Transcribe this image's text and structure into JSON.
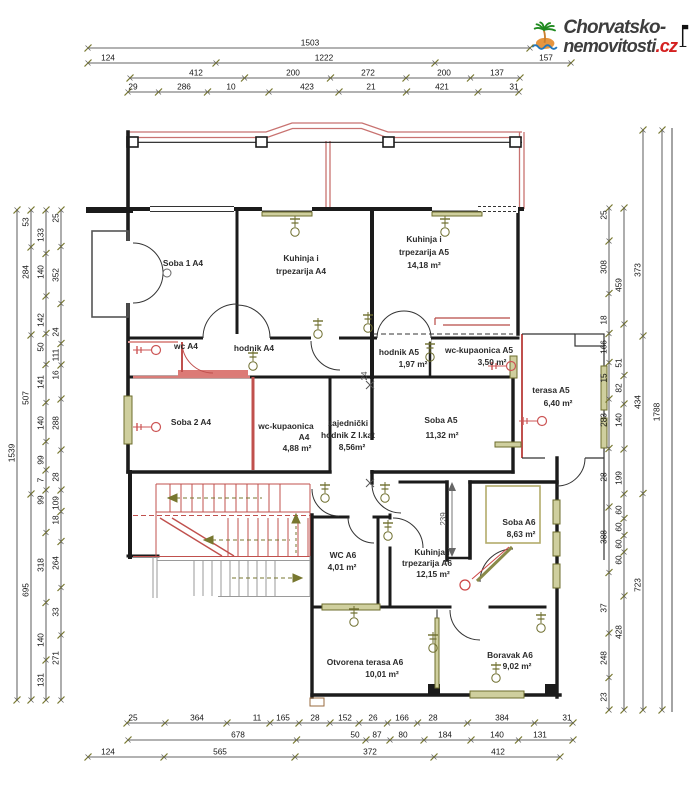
{
  "logo": {
    "line1": "Chorvatsko-",
    "line2": "nemovitosti",
    "tld": ".cz"
  },
  "colors": {
    "wall": "#1b1b1b",
    "red_wall": "#c0504d",
    "pink": "#dd8b87",
    "olive": "#77772f",
    "olive_fill": "#cfcf9e",
    "gray": "#9a9a9a",
    "logo_green": "#1f8a1f",
    "logo_orange": "#e6953f",
    "logo_blue": "#2277bb",
    "logo_red": "#d42020"
  },
  "rooms": [
    {
      "id": "soba1_a4",
      "lines": [
        "Soba 1 A4"
      ]
    },
    {
      "id": "kuhinja_a4",
      "lines": [
        "Kuhinja i",
        "trpezarija A4"
      ]
    },
    {
      "id": "kuhinja_a5",
      "lines": [
        "Kuhinja i",
        "trpezarija A5",
        "14,18 m²"
      ]
    },
    {
      "id": "wc_a4",
      "lines": [
        "wc A4"
      ]
    },
    {
      "id": "hodnik_a4",
      "lines": [
        "hodnik A4"
      ]
    },
    {
      "id": "hodnik_a5",
      "lines": [
        "hodnik A5",
        "1,97 m²"
      ]
    },
    {
      "id": "wc_kup_a5",
      "lines": [
        "wc-kupaonica A5",
        "3,50 m²"
      ]
    },
    {
      "id": "terasa_a5",
      "lines": [
        "terasa A5",
        "6,40 m²"
      ]
    },
    {
      "id": "soba2_a4",
      "lines": [
        "Soba 2 A4"
      ]
    },
    {
      "id": "wc_kup_a4",
      "lines": [
        "wc-kupaonica",
        "A4",
        "4,88 m²"
      ]
    },
    {
      "id": "zajednicki",
      "lines": [
        "zajednički",
        "hodnik Z I.kat",
        "8,56m²"
      ]
    },
    {
      "id": "soba_a5",
      "lines": [
        "Soba A5",
        "11,32 m²"
      ]
    },
    {
      "id": "soba_a6",
      "lines": [
        "Soba A6",
        "8,63 m²"
      ]
    },
    {
      "id": "wc_a6",
      "lines": [
        "WC A6",
        "4,01 m²"
      ]
    },
    {
      "id": "kuhinja_a6",
      "lines": [
        "Kuhinja i",
        "trpezarija A6",
        "12,15 m²"
      ]
    },
    {
      "id": "otvorena_terasa_a6",
      "lines": [
        "Otvorena terasa A6",
        "10,01 m²"
      ]
    },
    {
      "id": "boravak_a6",
      "lines": [
        "Boravak A6",
        "9,02 m²"
      ]
    }
  ],
  "dims": {
    "top": [
      [
        "1503"
      ],
      [
        "124",
        "1222",
        "157"
      ],
      [
        "412",
        "200",
        "272",
        "200",
        "137"
      ],
      [
        "29",
        "286",
        "10",
        "423",
        "21",
        "421",
        "31"
      ]
    ],
    "bottom": [
      [
        "25",
        "364",
        "11",
        "165",
        "28",
        "152",
        "26",
        "166",
        "28",
        "384",
        "31"
      ],
      [
        "678",
        "50",
        "87",
        "80",
        "184",
        "140",
        "131"
      ],
      [
        "124",
        "565",
        "372",
        "412"
      ]
    ],
    "left": [
      [
        "1539"
      ],
      [
        "53",
        "284",
        "507",
        "695"
      ],
      [
        "133",
        "140",
        "142",
        "50",
        "141",
        "140",
        "99",
        "7",
        "99",
        "318",
        "140",
        "131"
      ],
      [
        "25",
        "352",
        "24",
        "111",
        "16",
        "288",
        "28",
        "109",
        "18",
        "264",
        "33",
        "271"
      ]
    ],
    "right": [
      [
        "25",
        "308",
        "18",
        "166",
        "15",
        "283",
        "28",
        "388",
        "37",
        "248",
        "23"
      ],
      [
        "459",
        "51",
        "82",
        "140",
        "199",
        "60",
        "60",
        "60",
        "60",
        "428"
      ],
      [
        "373",
        "434",
        "723"
      ],
      [
        "1788"
      ]
    ],
    "inline": [
      "239",
      "24"
    ]
  }
}
